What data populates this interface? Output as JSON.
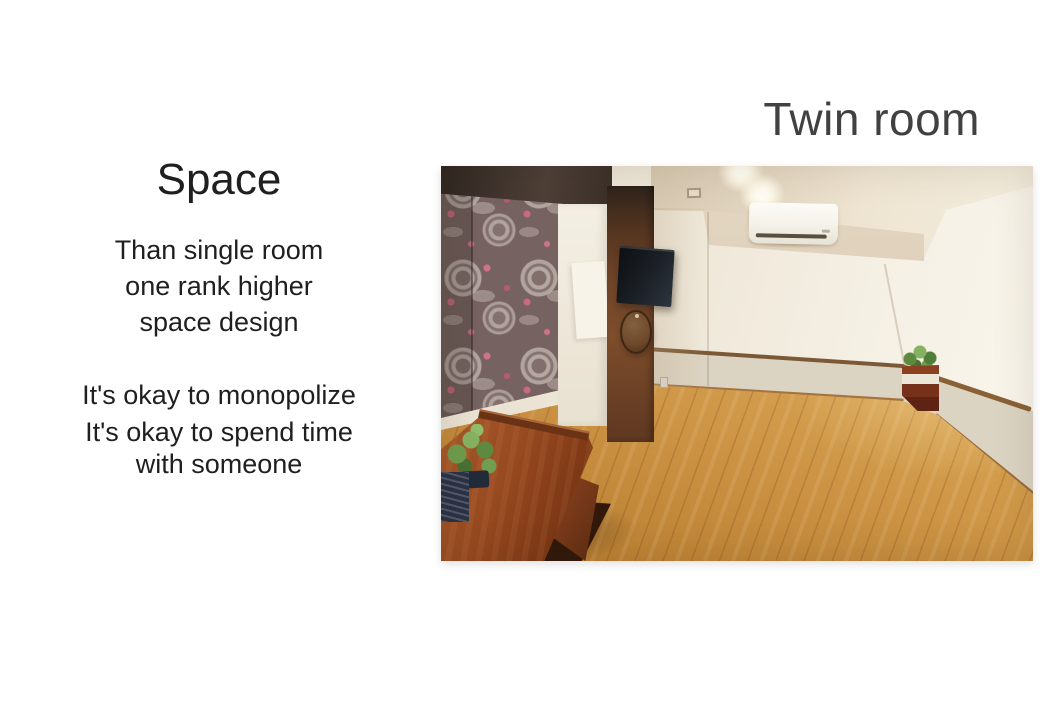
{
  "slide": {
    "title": "Twin room",
    "left_panel": {
      "heading": "Space",
      "paragraph1_lines": [
        "Than single room",
        "one rank higher",
        "space design"
      ],
      "paragraph2_lines": [
        "It's okay to monopolize",
        "It's okay to spend time",
        "with someone"
      ]
    },
    "photo": {
      "description": "Twin room interior: floral roller curtain, wall-mounted TV on dark wood panel, air conditioner, recessed ceiling lights, corner shelf with plant, wooden desk with plant and bench, light wooden floor"
    },
    "colors": {
      "background": "#ffffff",
      "title_text": "#414141",
      "body_text": "#1f1f1f",
      "floor_wood": "#cc9344",
      "curtain_base": "#766260",
      "curtain_pink": "#cf7389",
      "wall_cream": "#f0e9db",
      "wall_band": "#dcd4c3",
      "rail_brown": "#7b5936",
      "panel_wood": "#6e4428",
      "desk_wood": "#96481f",
      "plant_green": "#6f9c4d",
      "tv_black": "#12161b",
      "ac_white": "#f6f4ee"
    }
  }
}
